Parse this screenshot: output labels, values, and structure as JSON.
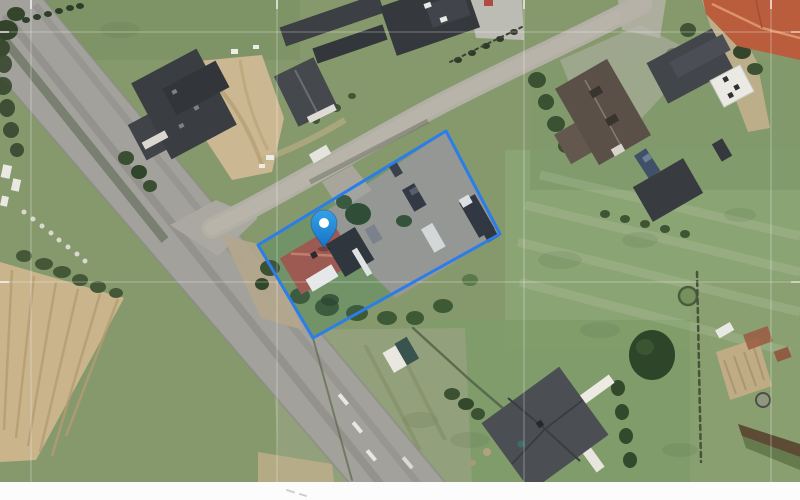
{
  "map": {
    "kind": "satellite-aerial-view",
    "parcel": {
      "outline_color": "#2b7de9",
      "fill_color": "rgba(60,130,240,0.06)",
      "stroke_width": 3,
      "points": [
        [
          258,
          245
        ],
        [
          446,
          131
        ],
        [
          500,
          234
        ],
        [
          313,
          338
        ]
      ]
    },
    "marker": {
      "x": 324,
      "y": 248,
      "color_top": "#34a1e8",
      "color_bottom": "#1673c6",
      "inner_color": "#ffffff"
    },
    "grid": {
      "color": "#ffffff",
      "line_opacity": 0.35,
      "tick_opacity": 0.8,
      "vertical_x": [
        31,
        277,
        524,
        771
      ],
      "horizontal_y": [
        32,
        282
      ],
      "image_bottom": 482
    },
    "bottom_margin": {
      "y": 482,
      "height": 18,
      "color": "#fcfcfc"
    },
    "palette": {
      "grass": "#85996d",
      "road_asphalt": "#a2a19b",
      "secondary_road": "#b2afa5",
      "plowed_field": "#c9b48c",
      "sand": "#cbb791",
      "gravel_yard": "#99988f",
      "dark_roof": "#3a3d41",
      "red_roof": "#a2584a",
      "orange_roof": "#b95d3d",
      "brown_roof": "#5a5048"
    }
  }
}
